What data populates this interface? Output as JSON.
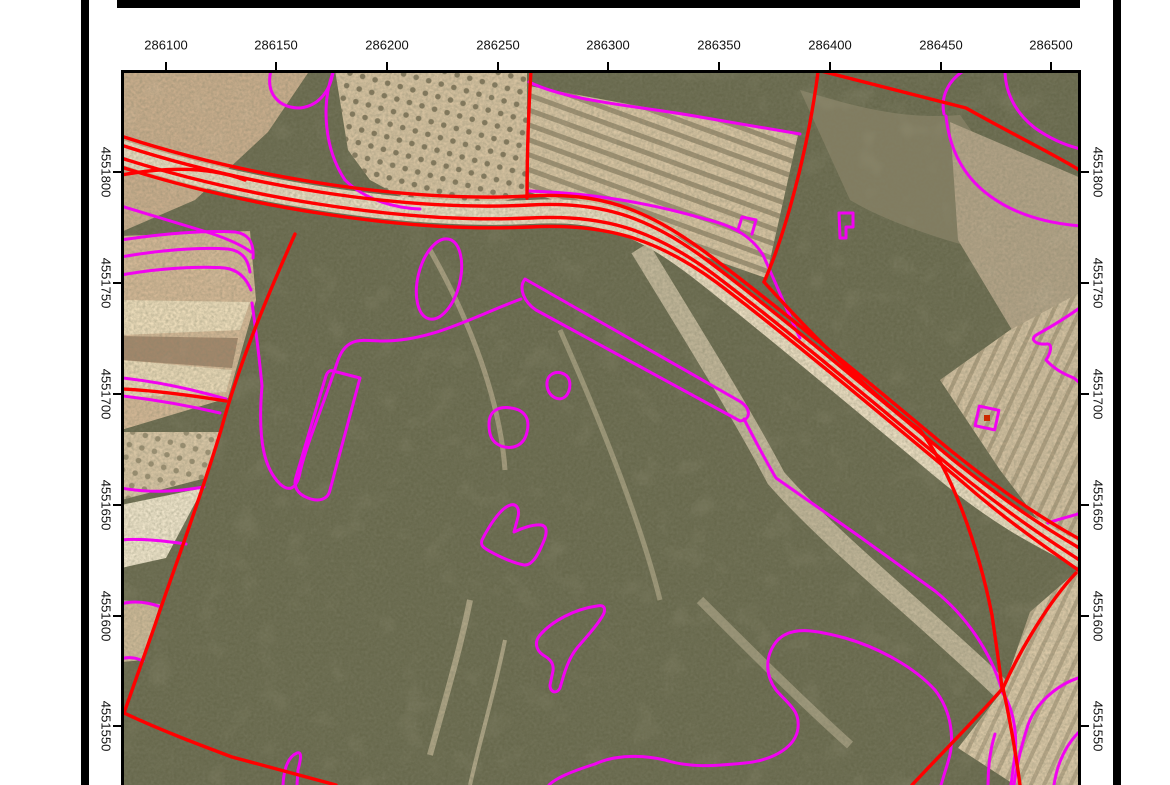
{
  "document": {
    "kind": "cadastral-orthophoto-map-sheet",
    "background": "#ffffff"
  },
  "map": {
    "axes": {
      "top": {
        "labels": [
          "286100",
          "286150",
          "286200",
          "286250",
          "286300",
          "286350",
          "286400",
          "286450",
          "286500"
        ],
        "tick_xs": [
          166,
          276,
          387,
          498,
          608,
          719,
          830,
          941,
          1051
        ],
        "label_y": 45,
        "tick_y1": 62,
        "tick_y2": 70
      },
      "left": {
        "labels": [
          "4551800",
          "4551750",
          "4551700",
          "4551650",
          "4551600",
          "4551550"
        ],
        "tick_ys": [
          172,
          283,
          394,
          505,
          616,
          726
        ],
        "label_x": 106,
        "tick_x1": 113,
        "tick_x2": 121
      },
      "right": {
        "labels": [
          "4551800",
          "4551750",
          "4551700",
          "4551650",
          "4551600",
          "4551550"
        ],
        "tick_ys": [
          172,
          283,
          394,
          505,
          616,
          726
        ],
        "label_x": 1098,
        "tick_x1": 1081,
        "tick_x2": 1089
      }
    },
    "colors": {
      "parcel_boundary": "#ff0000",
      "subparcel_boundary": "#f103f1",
      "frame": "#000000",
      "label_text": "#111111",
      "scrub": "#67684c",
      "field_beige": "#d6c2a0",
      "field_pale": "#ecdcba",
      "field_pink": "#c9ad8c",
      "track_pale": "#e9dcc0"
    },
    "legend_semantics": {
      "red_lines": "parcel boundaries / road",
      "magenta_lines": "sub-parcel enclosure boundaries"
    }
  }
}
